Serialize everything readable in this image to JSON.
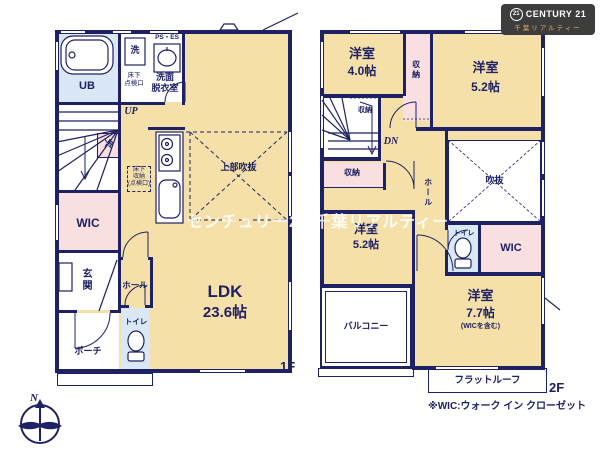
{
  "brand": {
    "badge": "21",
    "name": "CENTURY 21",
    "subtitle": "千葉リアルティー"
  },
  "watermark": "センチュリー21 千葉リアルティー",
  "compass_label": "N",
  "footnote": "※WIC:ウォーク イン クローゼット",
  "colors": {
    "wall": "#1e2264",
    "room_tan": "#f5e0a9",
    "closet_pink": "#f9dfdf",
    "wet_blue": "#d9e8f4",
    "logo_bg": "#3d3d3d",
    "logo_gold": "#d8ae62"
  },
  "floor1": {
    "label": "1F",
    "ub": "UB",
    "washer": "洗",
    "ps_es": "PS・ES",
    "senmen": "洗面\n脱衣室",
    "yukashita_tenken": "床下\n点検口",
    "up": "UP",
    "rei": "冷",
    "yukashita_shuno": "床下\n収納\n(点検口)",
    "wic": "WIC",
    "genkan": "玄関",
    "hall": "ホール",
    "toilet": "トイレ",
    "porch": "ポーチ",
    "ldk_name": "LDK",
    "ldk_size": "23.6帖",
    "joubu_fukinuke": "上部吹抜"
  },
  "floor2": {
    "label": "2F",
    "room40_name": "洋室",
    "room40_size": "4.0帖",
    "room52a_name": "洋室",
    "room52a_size": "5.2帖",
    "room52b_name": "洋室",
    "room52b_size": "5.2帖",
    "room77_name": "洋室",
    "room77_size": "7.7帖",
    "room77_note": "(WICを含む)",
    "shuno_a": "収納",
    "shuno_b": "収納",
    "shuno_c": "収納",
    "dn": "DN",
    "hall": "ホール",
    "fukinuke": "吹抜",
    "toilet": "トイレ",
    "wic": "WIC",
    "balcony": "バルコニー",
    "flat_roof": "フラットルーフ"
  }
}
